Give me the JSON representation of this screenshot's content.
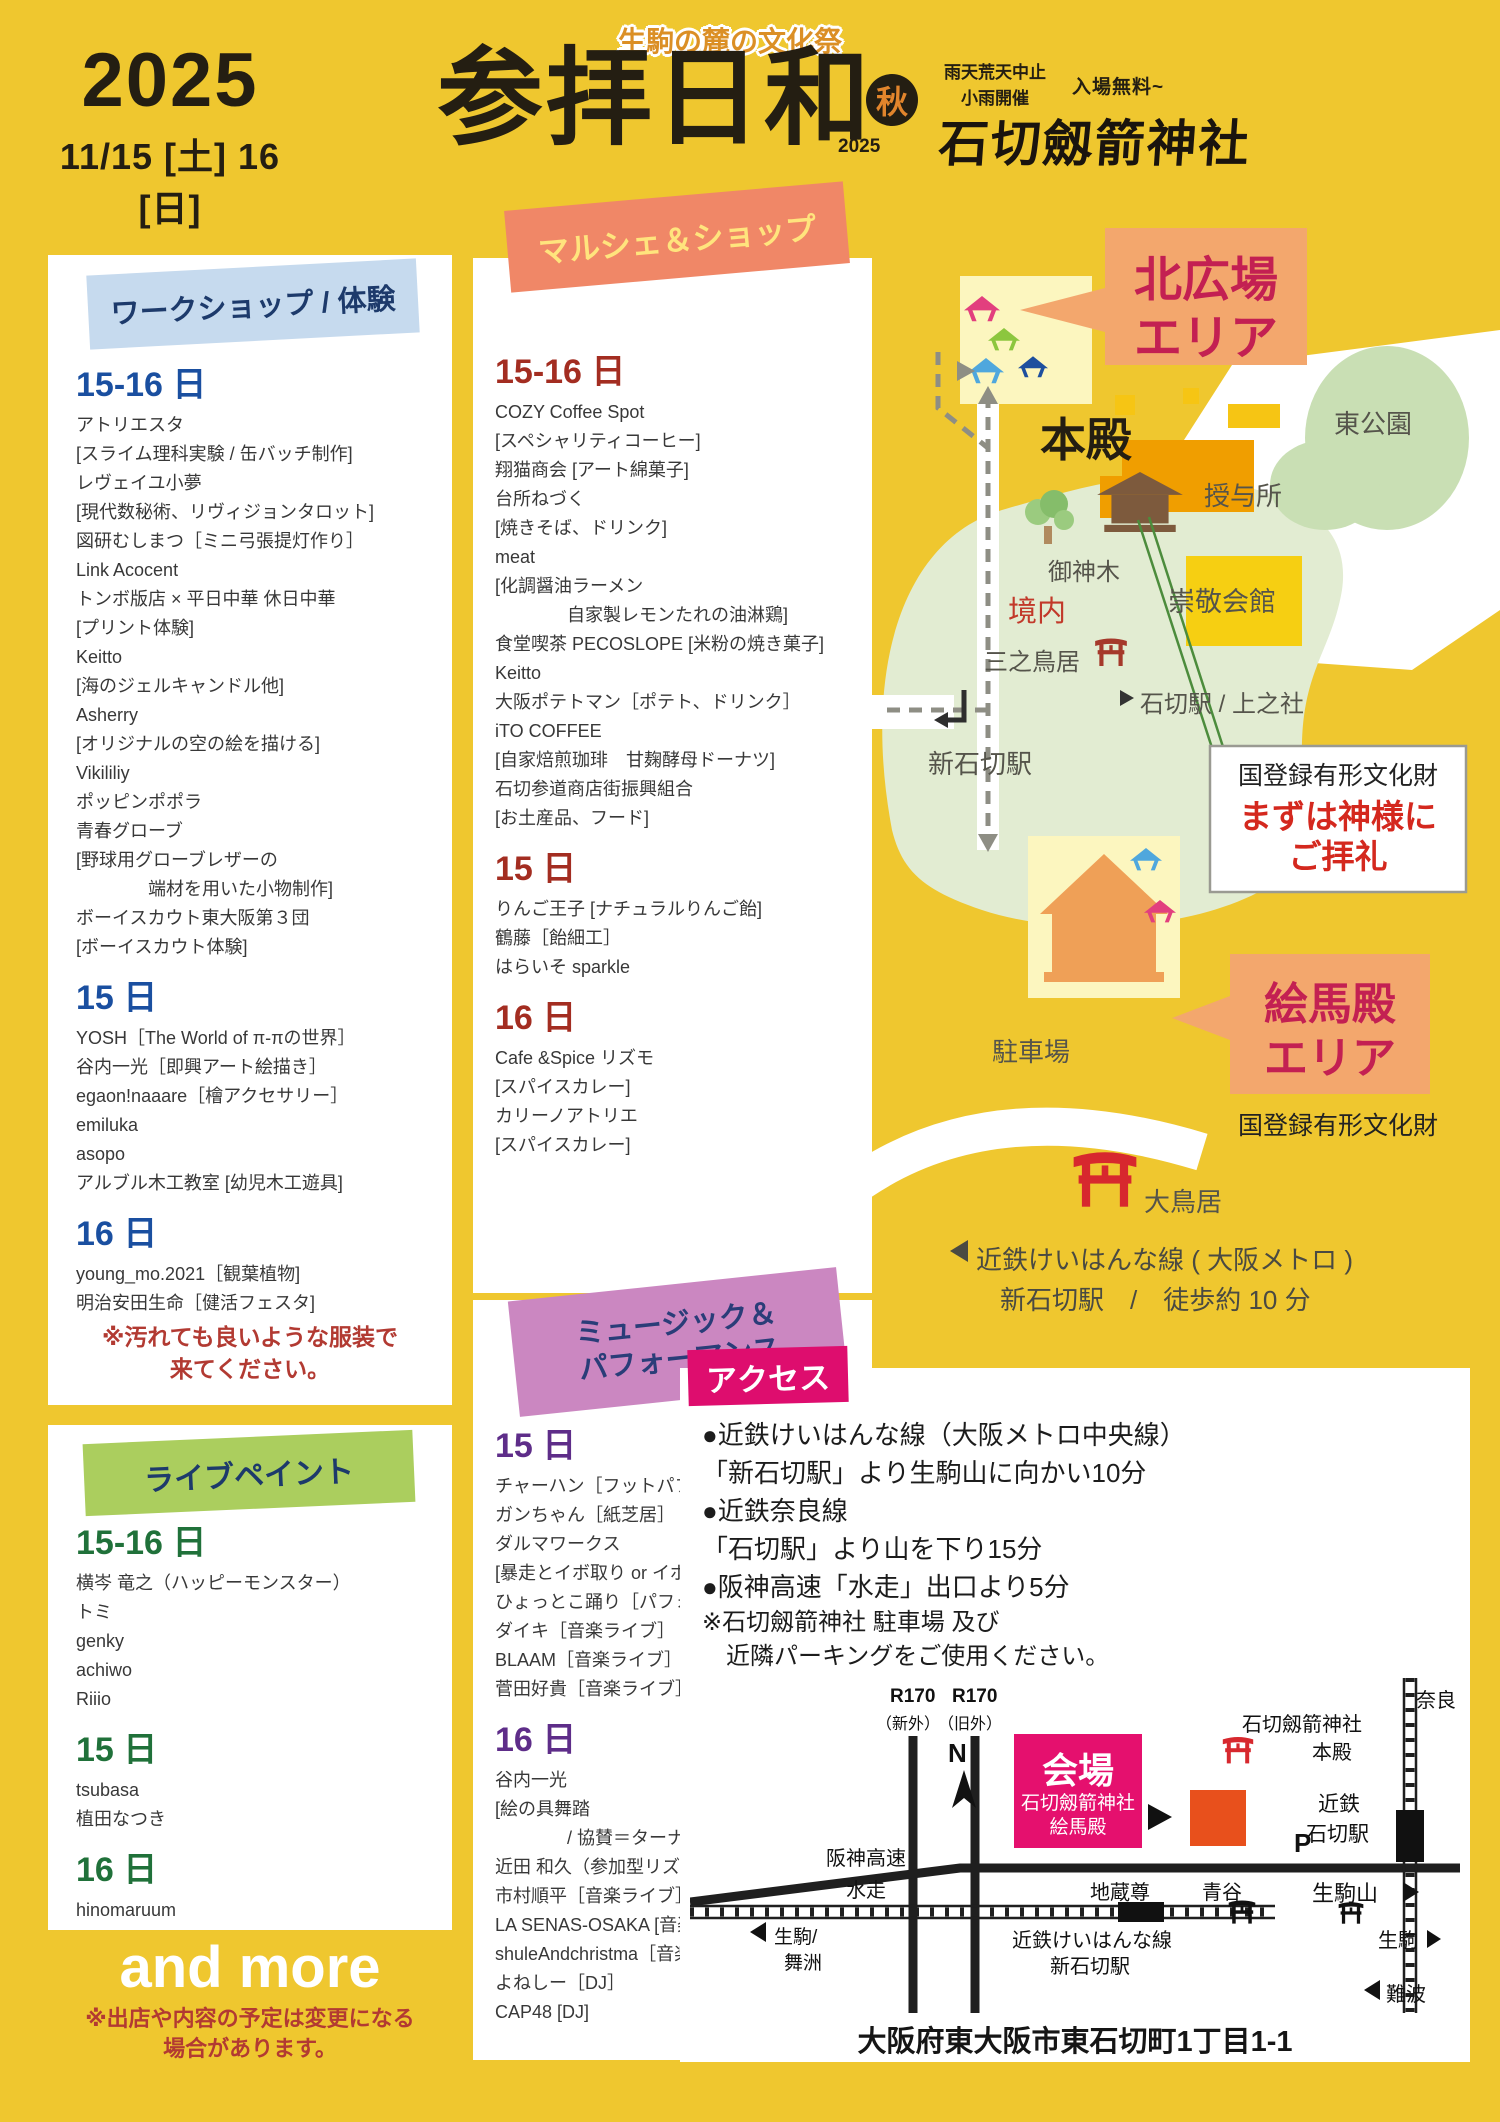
{
  "colors": {
    "background": "#efc72f",
    "accent_magenta": "#e5106e",
    "salmon_area_box": "#f3a76d",
    "crimson_area_text": "#c32052",
    "torii_red": "#d7282e",
    "workshop_blue": "#1a4fa0",
    "marche_red": "#a32d21",
    "music_purple": "#5e2d89",
    "livepaint_green": "#20713a"
  },
  "header": {
    "year": "2025",
    "dates": "11/15 [土] 16 [日]",
    "tagline": "生駒の麓の文化祭",
    "title": "参拝日和",
    "title_year": "2025",
    "season_badge": "秋",
    "weather_line1": "雨天荒天中止",
    "weather_line2": "小雨開催",
    "admission": "入場無料~",
    "shrine": "石切劔箭神社"
  },
  "workshop": {
    "title": "ワークショップ / 体験",
    "list": [
      {
        "t": "day",
        "x": "15-16 日"
      },
      {
        "t": "item",
        "x": "アトリエスタ"
      },
      {
        "t": "item",
        "x": "[スライム理科実験 / 缶バッチ制作]"
      },
      {
        "t": "item",
        "x": "レヴェイユ小夢"
      },
      {
        "t": "item",
        "x": "[現代数秘術、リヴィジョンタロット]"
      },
      {
        "t": "item",
        "x": "図研むしまつ［ミニ弓張提灯作り］"
      },
      {
        "t": "item",
        "x": "Link Acocent"
      },
      {
        "t": "item",
        "x": "トンボ版店 × 平日中華 休日中華"
      },
      {
        "t": "item",
        "x": "[プリント体験]"
      },
      {
        "t": "item",
        "x": "Keitto"
      },
      {
        "t": "item",
        "x": "[海のジェルキャンドル他]"
      },
      {
        "t": "item",
        "x": "Asherry"
      },
      {
        "t": "item",
        "x": "[オリジナルの空の絵を描ける]"
      },
      {
        "t": "item",
        "x": "Vikililiy"
      },
      {
        "t": "item",
        "x": "ポッピンポポラ"
      },
      {
        "t": "item",
        "x": "青春グローブ"
      },
      {
        "t": "item",
        "x": "[野球用グローブレザーの"
      },
      {
        "t": "ind",
        "x": "端材を用いた小物制作]"
      },
      {
        "t": "item",
        "x": "ボーイスカウト東大阪第３団"
      },
      {
        "t": "item",
        "x": "[ボーイスカウト体験]"
      },
      {
        "t": "day",
        "x": "15 日"
      },
      {
        "t": "item",
        "x": "YOSH［The World of π-πの世界］"
      },
      {
        "t": "item",
        "x": "谷内一光［即興アート絵描き］"
      },
      {
        "t": "item",
        "x": "egaon!naaare［檜アクセサリー］"
      },
      {
        "t": "item",
        "x": "emiluka"
      },
      {
        "t": "item",
        "x": "asopo"
      },
      {
        "t": "item",
        "x": "アルブル木工教室 [幼児木工遊具]"
      },
      {
        "t": "day",
        "x": "16 日"
      },
      {
        "t": "item",
        "x": "young_mo.2021［観葉植物]"
      },
      {
        "t": "item",
        "x": "明治安田生命［健活フェスタ]"
      }
    ],
    "note1": "※汚れても良いような服装で",
    "note2": "来てください。"
  },
  "marche": {
    "title": "マルシェ＆ショップ",
    "list": [
      {
        "t": "day",
        "x": "15-16 日"
      },
      {
        "t": "item",
        "x": "COZY Coffee Spot"
      },
      {
        "t": "item",
        "x": "[スペシャリティコーヒー]"
      },
      {
        "t": "item",
        "x": "翔猫商会 [アート綿菓子]"
      },
      {
        "t": "item",
        "x": "台所ねづく"
      },
      {
        "t": "item",
        "x": "[焼きそば、ドリンク]"
      },
      {
        "t": "item",
        "x": "meat"
      },
      {
        "t": "item",
        "x": "[化調醤油ラーメン"
      },
      {
        "t": "ind",
        "x": "自家製レモンたれの油淋鶏]"
      },
      {
        "t": "item",
        "x": "食堂喫茶 PECOSLOPE [米粉の焼き菓子]"
      },
      {
        "t": "item",
        "x": "Keitto"
      },
      {
        "t": "item",
        "x": "大阪ポテトマン［ポテト、ドリンク］"
      },
      {
        "t": "item",
        "x": "iTO COFFEE"
      },
      {
        "t": "item",
        "x": "[自家焙煎珈琲　甘麹酵母ドーナツ]"
      },
      {
        "t": "item",
        "x": "石切参道商店街振興組合"
      },
      {
        "t": "item",
        "x": "[お土産品、フード]"
      },
      {
        "t": "day",
        "x": "15 日"
      },
      {
        "t": "item",
        "x": "りんご王子 [ナチュラルりんご飴]"
      },
      {
        "t": "item",
        "x": "鶴藤［飴細工］"
      },
      {
        "t": "item",
        "x": "はらいそ sparkle"
      },
      {
        "t": "day",
        "x": "16 日"
      },
      {
        "t": "item",
        "x": "Cafe &Spice リズモ"
      },
      {
        "t": "item",
        "x": "[スパイスカレー]"
      },
      {
        "t": "item",
        "x": "カリーノアトリエ"
      },
      {
        "t": "item",
        "x": "[スパイスカレー]"
      }
    ]
  },
  "music": {
    "title1": "ミュージック＆",
    "title2": "パフォーマンス",
    "list": [
      {
        "t": "day",
        "x": "15 日"
      },
      {
        "t": "item",
        "x": "チャーハン［フットパフォーマー］"
      },
      {
        "t": "item",
        "x": "ガンちゃん［紙芝居］"
      },
      {
        "t": "item",
        "x": "ダルマワークス"
      },
      {
        "t": "item",
        "x": "[暴走とイボ取り or イボ取りと暴走]"
      },
      {
        "t": "item",
        "x": "ひょっとこ踊り［パフォーマンス］"
      },
      {
        "t": "item",
        "x": "ダイキ［音楽ライブ］"
      },
      {
        "t": "item",
        "x": "BLAAM［音楽ライブ］"
      },
      {
        "t": "item",
        "x": "菅田好貴［音楽ライブ］"
      },
      {
        "t": "day",
        "x": "16 日"
      },
      {
        "t": "item",
        "x": "谷内一光"
      },
      {
        "t": "item",
        "x": "[絵の具舞踏"
      },
      {
        "t": "ind",
        "x": "/ 協賛＝ターナー色彩株式会社]"
      },
      {
        "t": "item",
        "x": "近田 和久（参加型リズムワーク）"
      },
      {
        "t": "item",
        "x": "市村順平［音楽ライブ］"
      },
      {
        "t": "item",
        "x": "LA SENAS-OSAKA [音楽ライブ]"
      },
      {
        "t": "item",
        "x": "shuleAndchristma［音楽ライブ］"
      },
      {
        "t": "item",
        "x": "よねしー［DJ］"
      },
      {
        "t": "item",
        "x": "CAP48 [DJ]"
      }
    ]
  },
  "livepaint": {
    "title": "ライブペイント",
    "list": [
      {
        "t": "day",
        "x": "15-16 日"
      },
      {
        "t": "item",
        "x": "横岑 竜之（ハッピーモンスター）"
      },
      {
        "t": "item",
        "x": "トミ"
      },
      {
        "t": "item",
        "x": "genky"
      },
      {
        "t": "item",
        "x": "achiwo"
      },
      {
        "t": "item",
        "x": "Riiio"
      },
      {
        "t": "day",
        "x": "15 日"
      },
      {
        "t": "item",
        "x": "tsubasa"
      },
      {
        "t": "item",
        "x": "植田なつき"
      },
      {
        "t": "day",
        "x": "16 日"
      },
      {
        "t": "item",
        "x": "hinomaruum"
      }
    ]
  },
  "more": {
    "and_more": "and more",
    "note1": "※出店や内容の予定は変更になる",
    "note2": "場合があります。"
  },
  "map": {
    "kita1": "北広場",
    "kita2": "エリア",
    "higashi_park": "東公園",
    "honden": "本殿",
    "juyosho": "授与所",
    "goshinboku": "御神木",
    "keidai": "境内",
    "sukeikaikan": "崇敬会館",
    "sannotorii": "三之鳥居",
    "kamisha": "石切駅 / 上之社",
    "shin_ishikiri": "新石切駅",
    "bunkazai1": "国登録有形文化財",
    "worship1": "まずは神様に",
    "worship2": "ご拝礼",
    "emaden1": "絵馬殿",
    "emaden2": "エリア",
    "bunkazai2": "国登録有形文化財",
    "parking": "駐車場",
    "otorii": "大鳥居",
    "rail1": "近鉄けいはんな線 ( 大阪メトロ )",
    "rail2": "新石切駅　/　徒歩約 10 分"
  },
  "access": {
    "title": "アクセス",
    "lines": [
      {
        "t": "b",
        "x": "●近鉄けいはんな線（大阪メトロ中央線）"
      },
      {
        "t": "b",
        "x": "「新石切駅」より生駒山に向かい10分"
      },
      {
        "t": "b",
        "x": "●近鉄奈良線"
      },
      {
        "t": "b",
        "x": "「石切駅」より山を下り15分"
      },
      {
        "t": "b",
        "x": "●阪神高速「水走」出口より5分"
      },
      {
        "t": "note",
        "x": "※石切劔箭神社 駐車場 及び"
      },
      {
        "t": "note",
        "x": "　近隣パーキングをご使用ください。"
      }
    ],
    "address": "大阪府東大阪市東石切町1丁目1-1"
  },
  "streetmap": {
    "r170a_1": "R170",
    "r170a_2": "（新外）",
    "r170b_1": "R170",
    "r170b_2": "（旧外）",
    "nara": "奈良",
    "shrine1": "石切劔箭神社",
    "shrine2": "本殿",
    "north": "N",
    "kaijo": "会場",
    "kaijo_sub1": "石切劔箭神社",
    "kaijo_sub2": "絵馬殿",
    "kintetsu1": "近鉄",
    "kintetsu2": "石切駅",
    "p": "P",
    "ikomayama": "生駒山",
    "hanshin1": "阪神高速",
    "hanshin2": "水走",
    "jizoson": "地蔵尊",
    "aotani": "青谷",
    "ikoma_maishima1": "生駒/",
    "ikoma_maishima2": "舞洲",
    "keihanna1": "近鉄けいはんな線",
    "keihanna2": "新石切駅",
    "ikoma": "生駒",
    "namba": "難波"
  }
}
